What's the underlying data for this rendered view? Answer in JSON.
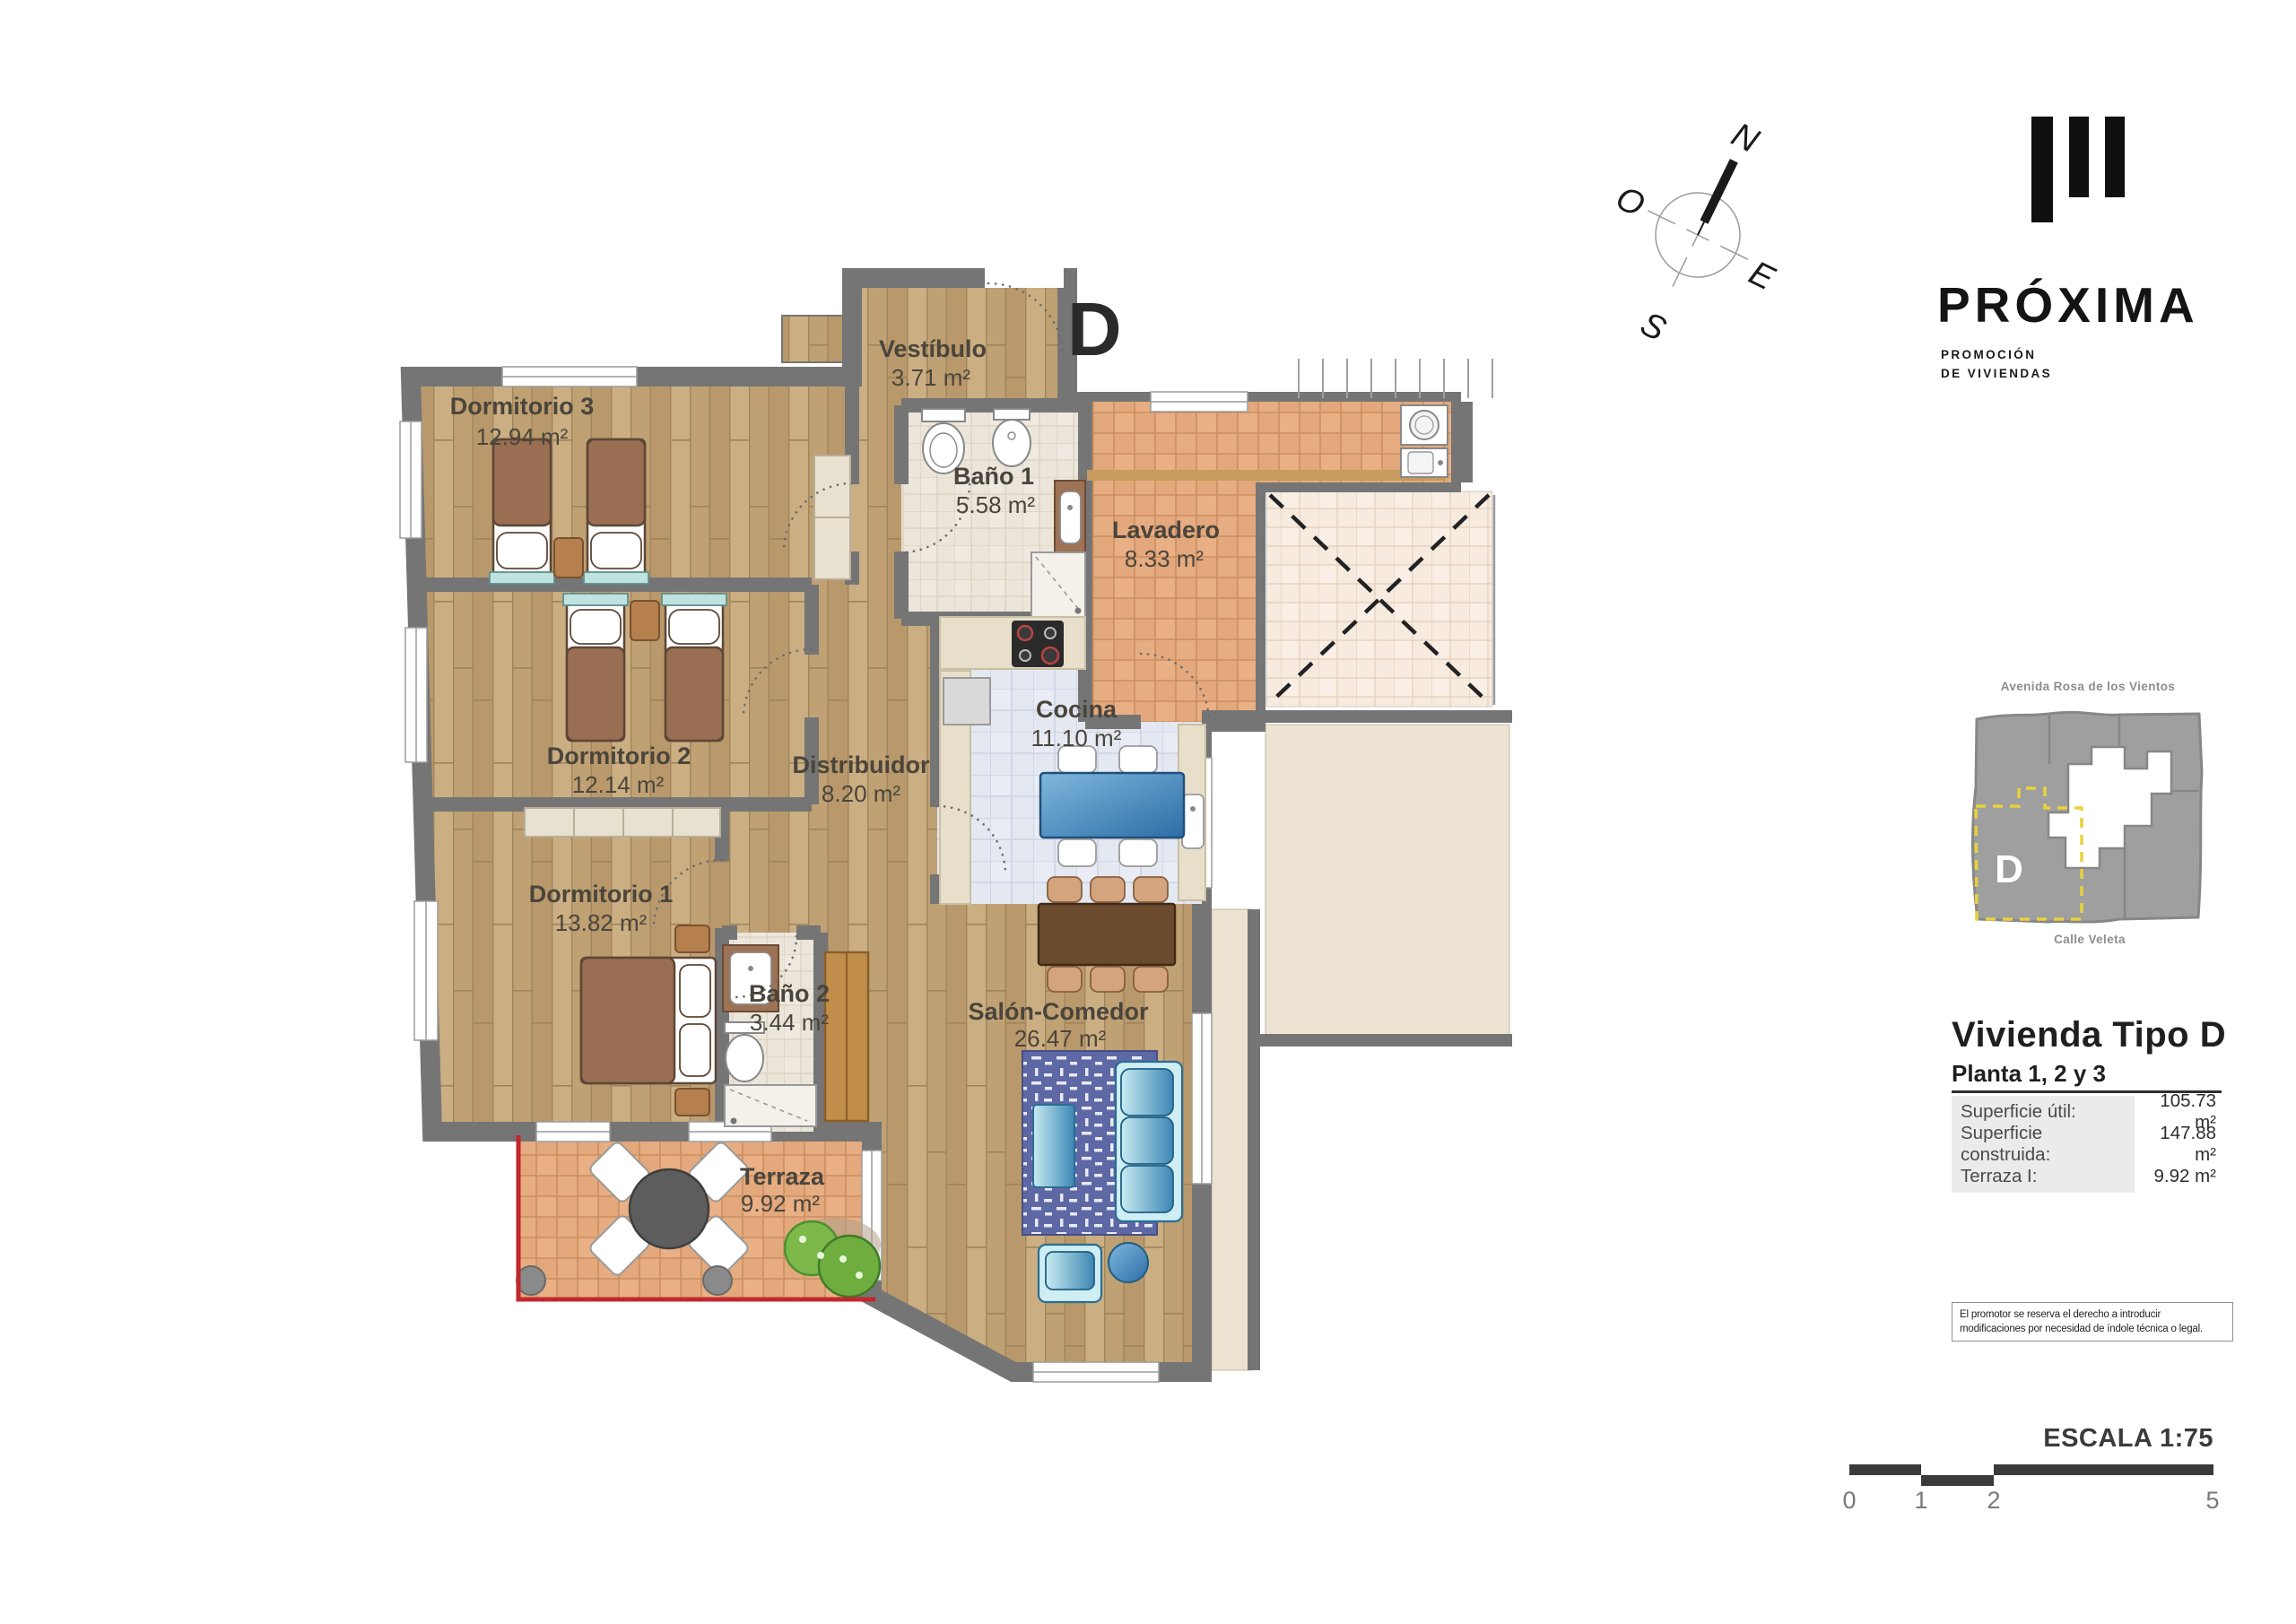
{
  "plan": {
    "unit_letter": "D",
    "rooms": [
      {
        "name": "Dormitorio 3",
        "area": "12.94 m²"
      },
      {
        "name": "Vestíbulo",
        "area": "3.71 m²"
      },
      {
        "name": "Baño 1",
        "area": "5.58 m²"
      },
      {
        "name": "Lavadero",
        "area": "8.33 m²"
      },
      {
        "name": "Cocina",
        "area": "11.10 m²"
      },
      {
        "name": "Dormitorio 2",
        "area": "12.14 m²"
      },
      {
        "name": "Distribuidor",
        "area": "8.20 m²"
      },
      {
        "name": "Dormitorio 1",
        "area": "13.82 m²"
      },
      {
        "name": "Baño 2",
        "area": "3.44 m²"
      },
      {
        "name": "Salón-Comedor",
        "area": "26.47 m²"
      },
      {
        "name": "Terraza",
        "area": "9.92 m²"
      }
    ],
    "colors": {
      "wall": "#757575",
      "terrace_line": "#c1272d",
      "wood": "#c2a478",
      "accent_yellow": "#e8d23c"
    }
  },
  "compass": {
    "n": "N",
    "o": "O",
    "e": "E",
    "s": "S"
  },
  "brand": {
    "name": "PRÓXIMA",
    "tagline_line1": "PROMOCIÓN",
    "tagline_line2": "DE VIVIENDAS"
  },
  "minimap": {
    "street_top": "Avenida Rosa de los Vientos",
    "street_bottom": "Calle Veleta",
    "unit_label": "D"
  },
  "info": {
    "title": "Vivienda Tipo D",
    "subtitle": "Planta 1, 2 y 3",
    "rows": [
      {
        "label": "Superficie útil:",
        "value": "105.73 m²"
      },
      {
        "label": "Superficie construida:",
        "value": "147.88 m²"
      },
      {
        "label": "Terraza I:",
        "value": "9.92 m²"
      }
    ]
  },
  "disclaimer": "El promotor se reserva el derecho a introducir modificaciones por necesidad de índole técnica o legal.",
  "scale": {
    "label": "ESCALA 1:75",
    "ticks": [
      "0",
      "1",
      "2",
      "5"
    ]
  }
}
